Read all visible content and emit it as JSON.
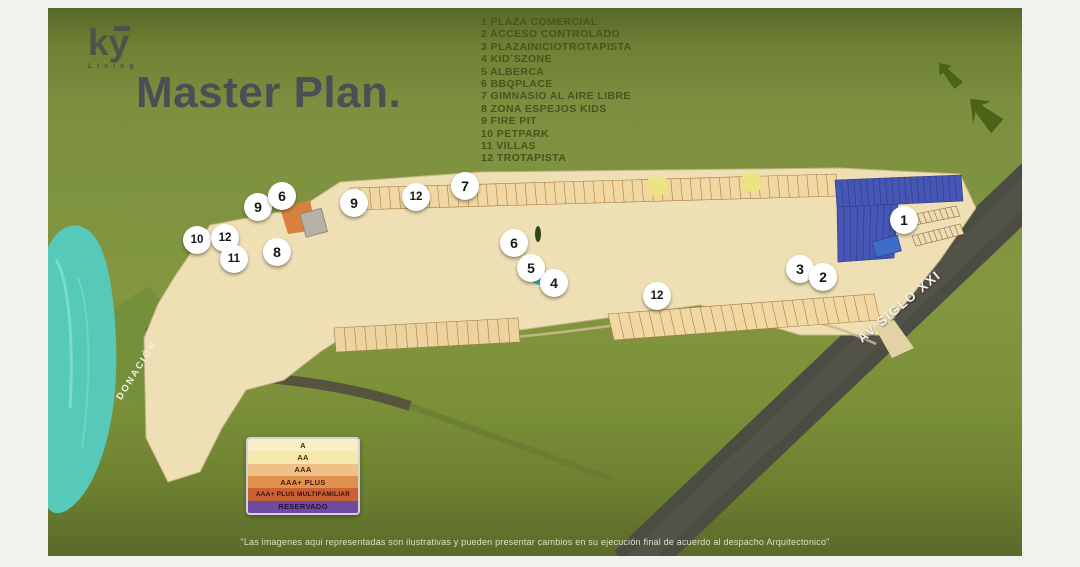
{
  "brand": {
    "logo_text": "ky",
    "logo_subtext": "Living"
  },
  "title": "Master Plan.",
  "amenities": [
    {
      "num": "1",
      "label": "PLAZA COMERCIAL"
    },
    {
      "num": "2",
      "label": "ACCESO CONTROLADO"
    },
    {
      "num": "3",
      "label": "PLAZAINICIOTROTAPISTA"
    },
    {
      "num": "4",
      "label": "KID´SZONE"
    },
    {
      "num": "5",
      "label": "ALBERCA"
    },
    {
      "num": "6",
      "label": "BBQPLACE"
    },
    {
      "num": "7",
      "label": "GIMNASIO AL AIRE LIBRE"
    },
    {
      "num": "8",
      "label": "ZONA ESPEJOS KIDS"
    },
    {
      "num": "9",
      "label": "FIRE PIT"
    },
    {
      "num": "10",
      "label": "PETPARK"
    },
    {
      "num": "11",
      "label": "VILLAS"
    },
    {
      "num": "12",
      "label": "TROTAPISTA"
    }
  ],
  "map": {
    "labels": {
      "road": "AV SIGLO XXI",
      "donation": "DONACIÓN"
    },
    "markers": [
      {
        "n": "10",
        "x": 149,
        "y": 232
      },
      {
        "n": "12",
        "x": 177,
        "y": 230
      },
      {
        "n": "11",
        "x": 186,
        "y": 251
      },
      {
        "n": "9",
        "x": 210,
        "y": 199
      },
      {
        "n": "6",
        "x": 234,
        "y": 188
      },
      {
        "n": "8",
        "x": 229,
        "y": 244
      },
      {
        "n": "9",
        "x": 306,
        "y": 195
      },
      {
        "n": "12",
        "x": 368,
        "y": 189
      },
      {
        "n": "7",
        "x": 417,
        "y": 178
      },
      {
        "n": "6",
        "x": 466,
        "y": 235
      },
      {
        "n": "5",
        "x": 483,
        "y": 260
      },
      {
        "n": "4",
        "x": 506,
        "y": 275
      },
      {
        "n": "12",
        "x": 609,
        "y": 288
      },
      {
        "n": "3",
        "x": 752,
        "y": 261
      },
      {
        "n": "2",
        "x": 775,
        "y": 269
      },
      {
        "n": "1",
        "x": 856,
        "y": 212
      }
    ]
  },
  "category_legend": [
    {
      "label": "A",
      "bg": "#f9efc6",
      "fg": "#4a2a10"
    },
    {
      "label": "AA",
      "bg": "#f6e7ab",
      "fg": "#4a2a10"
    },
    {
      "label": "AAA",
      "bg": "#eec189",
      "fg": "#4a2208"
    },
    {
      "label": "AAA+ PLUS",
      "bg": "#e0914e",
      "fg": "#521606"
    },
    {
      "label": "AAA+ PLUS MULTIFAMILIAR",
      "bg": "#c96134",
      "fg": "#3a0c06"
    },
    {
      "label": "RESERVADO",
      "bg": "#6f4aa0",
      "fg": "#26103e"
    }
  ],
  "disclaimer": "\"Las imagenes aqui representadas son ilustrativas y pueden presentar cambios en su ejecución final de acuerdo al despacho Arquitectonico\"",
  "colors": {
    "background": "#82973f",
    "title_text": "#4a4f55",
    "amenities_text": "#46561e",
    "pavement": "#eedfb5",
    "solar_blue": "#4656b4",
    "villas_purple": "#6b3fa0",
    "reserved_red": "#b23230",
    "river_teal": "#57c9b8"
  }
}
